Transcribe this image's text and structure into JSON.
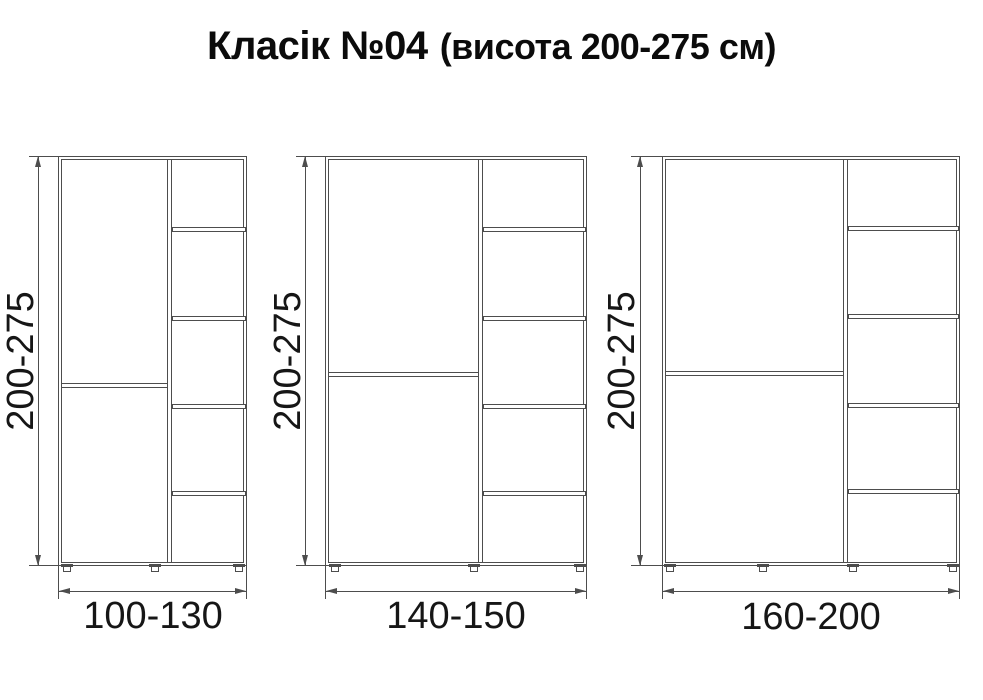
{
  "title": {
    "main": "Класік №04",
    "suffix": "(висота 200-275 см)"
  },
  "cabinets": [
    {
      "id": "cabinet-1",
      "height_label": "200-275",
      "width_label": "100-130",
      "shelf_compartments": 5,
      "feet": 3
    },
    {
      "id": "cabinet-2",
      "height_label": "200-275",
      "width_label": "140-150",
      "shelf_compartments": 5,
      "feet": 3
    },
    {
      "id": "cabinet-3",
      "height_label": "200-275",
      "width_label": "160-200",
      "shelf_compartments": 5,
      "feet": 4
    }
  ],
  "colors": {
    "line": "#4d4d4d",
    "text": "#111111",
    "background": "#ffffff"
  }
}
